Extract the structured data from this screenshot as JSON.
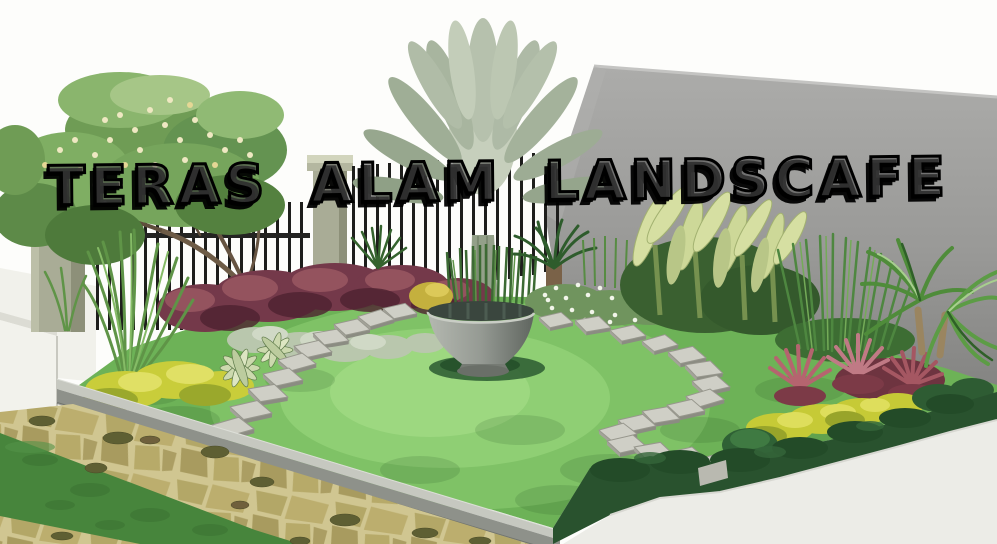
{
  "watermark": {
    "text": "TERAS ALAM LANDSCAFE"
  },
  "scene": {
    "description": "3D landscape-architecture rendering of a tropical home corner garden",
    "elements": [
      {
        "id": "sky",
        "label": "white sky background"
      },
      {
        "id": "house-wall",
        "label": "large plain gray gable wall"
      },
      {
        "id": "boundary-fence",
        "label": "black vertical-bar fence between concrete pillars"
      },
      {
        "id": "white-boundary-wall",
        "label": "low white garden wall at left edge"
      },
      {
        "id": "frangipani-tree",
        "label": "flowering tree with pale yellow blossoms"
      },
      {
        "id": "travelers-palm",
        "label": "pale fan palm behind center planter"
      },
      {
        "id": "water-bowl-planter",
        "label": "large gray bowl water feature"
      },
      {
        "id": "circular-lawn",
        "label": "bright green circular lawn"
      },
      {
        "id": "stepping-stone-path",
        "label": "curving square stepping stones"
      },
      {
        "id": "purple-shrub-border",
        "label": "maroon shrub bed along fence"
      },
      {
        "id": "yellow-shrub-accents",
        "label": "yellow-green accent shrubs"
      },
      {
        "id": "agave-rosettes",
        "label": "striped spiky rosette plants"
      },
      {
        "id": "cycad",
        "label": "small sago palm"
      },
      {
        "id": "white-flower-bed",
        "label": "bed of small white flowers"
      },
      {
        "id": "banana-plants",
        "label": "pale-leaved banana cluster"
      },
      {
        "id": "ornamental-grasses",
        "label": "tall grass clumps"
      },
      {
        "id": "red-cordylines",
        "label": "red-pink spiky cordyline clumps"
      },
      {
        "id": "pandanus-plant",
        "label": "arching strap-leaf plant at right"
      },
      {
        "id": "concrete-curb",
        "label": "gray concrete lawn edging"
      },
      {
        "id": "flagstone-path",
        "label": "tan crazy-paving with grass inlay strips"
      },
      {
        "id": "white-pavement",
        "label": "pale pavement at lower right"
      },
      {
        "id": "hedge-edge",
        "label": "dark green clipped hedge along lawn edge"
      }
    ],
    "palette": {
      "sky": "#fdfdfb",
      "wall_gray": "#9b9b99",
      "fence_black": "#1e1e1c",
      "pillar_sage": "#a9ac96",
      "foliage_green": "#6f9c55",
      "flower_cream": "#efe8c2",
      "palm_pale": "#b6c1ad",
      "lawn_green": "#82c468",
      "lawn_light": "#a2dc86",
      "purple_shrub": "#74394a",
      "yellow_shrub": "#c9cd3a",
      "cordyline_red": "#b5646f",
      "stone_gray": "#cfcfc6",
      "curb_gray": "#8e918a",
      "flagstone_tan": "#b3a767",
      "grass_strip": "#47853c",
      "hedge_dark": "#29522e",
      "pavement_white": "#ecece7",
      "bowl_gray": "#959a93"
    }
  }
}
